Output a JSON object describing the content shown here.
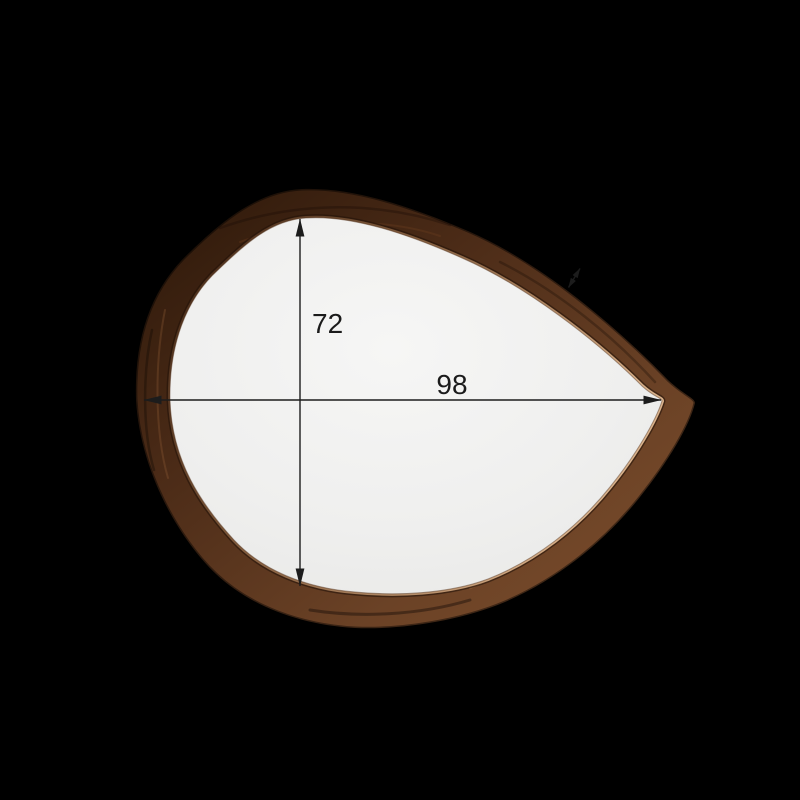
{
  "dimensions": {
    "height_label": "72",
    "width_label": "98"
  },
  "icons": {
    "height_arrow": "vertical-double-arrow",
    "width_arrow": "horizontal-double-arrow",
    "thickness_arrow": "diagonal-double-arrow"
  },
  "colors": {
    "background": "#000000",
    "glass_center": "#f6f6f5",
    "glass_edge": "#e8e8e6",
    "frame_dark": "#2b1709",
    "frame_mid": "#4b2b17",
    "frame_light": "#6b4226",
    "frame_highlight": "#7d4e2b",
    "rim": "#d9b28c",
    "dimension_line": "#1c1c1c",
    "dimension_text": "#1b1b1b"
  }
}
